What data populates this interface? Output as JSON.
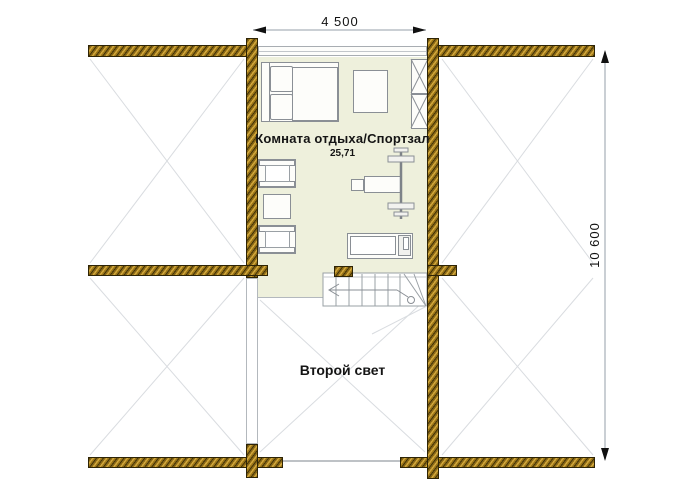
{
  "plan": {
    "room": {
      "label": "Комната отдыха/Спортзал",
      "area": "25,71"
    },
    "void": {
      "label": "Второй свет"
    },
    "dimensions": {
      "width": "4 500",
      "height": "10 600"
    }
  },
  "colors": {
    "wood": "#9c7618",
    "wood_dark": "#43340a",
    "floor": "#eef0dc",
    "faint_line": "#d9dce0",
    "dim_line": "#b9bfc6",
    "furniture_outline": "#8a8f95"
  },
  "furniture": [
    "bed",
    "table",
    "shelving-unit",
    "armchair",
    "side-table",
    "armchair",
    "bench-press",
    "treadmill",
    "stairs"
  ]
}
